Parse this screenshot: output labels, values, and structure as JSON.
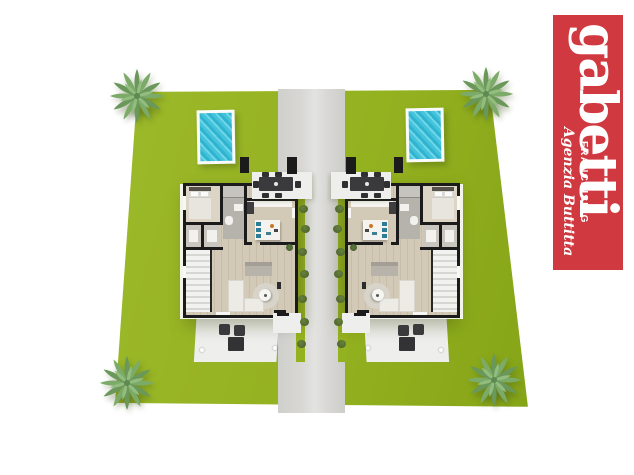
{
  "banner": {
    "brand": "gabetti",
    "franchising_label": "FRANCHISING",
    "agency_label": "Agenzia Buttitta"
  },
  "colors": {
    "canvas-bg": "#ffffff",
    "lawn": "#94b120",
    "lawn2": "#9cb92a",
    "lawn3": "#85a417",
    "path": "#d8d7d4",
    "patio": "#eeeeec",
    "wall": "#1b1b1b",
    "wood": "#d3c9b7",
    "wood-light": "#dcd4c4",
    "tile": "#b6b3ac",
    "tile2": "#c9c6bf",
    "counter": "#f4f3f0",
    "sofa-white": "#edebe5",
    "sofa-gray": "#b7b3ab",
    "rug": "#d8d4ca",
    "dark-furniture": "#3a3a3c",
    "pool-water": "#44c3dc",
    "pool-frame": "#fafafa",
    "stool-blue": "#2e7d96",
    "bush": "#51682f",
    "palm-dark": "#6a985a",
    "palm-mid": "#7cab69",
    "palm-light": "#93bd7f",
    "banner-red": "#d03940",
    "banner-text": "#ffffff"
  }
}
